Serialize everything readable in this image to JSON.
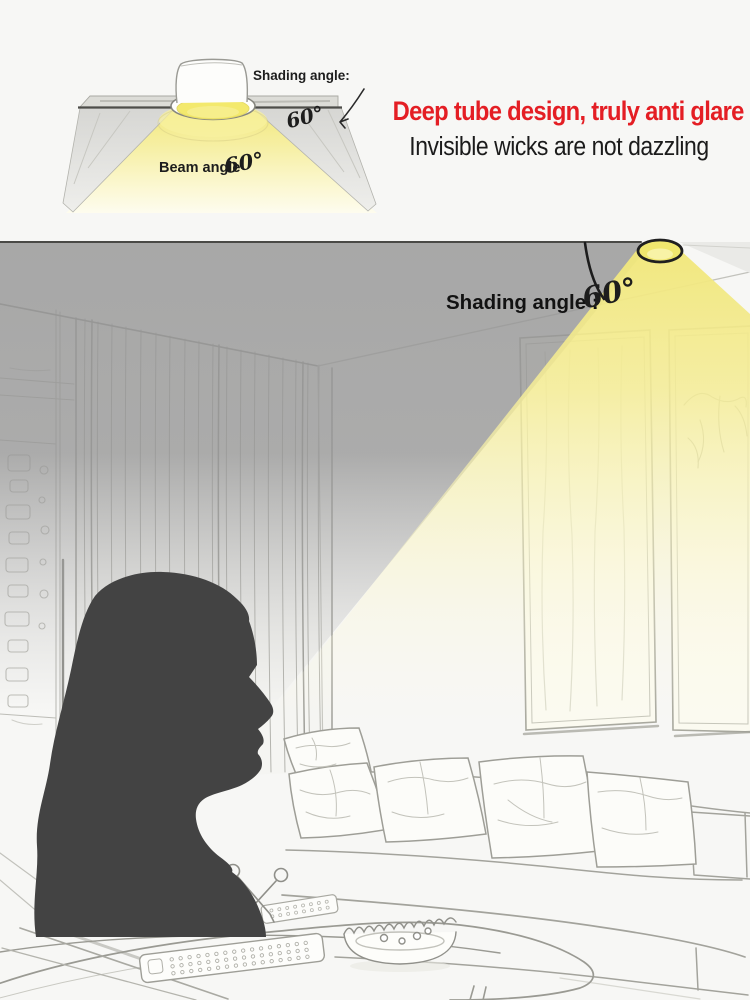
{
  "top_diagram": {
    "icon": "recessed-downlight-cross-section",
    "shading_angle_label": "Shading angle:",
    "shading_angle_value": "60°",
    "beam_angle_label": "Beam angle",
    "beam_angle_value": "60°"
  },
  "headline": {
    "title": "Deep tube design, truly anti glare",
    "title_color": "#e41e24",
    "subtitle": "Invisible wicks are not dazzling",
    "subtitle_color": "#1b1b1b"
  },
  "scene": {
    "shading_angle_label": "Shading angle :",
    "shading_angle_value": "60°",
    "beam_color": "#f2e87c",
    "ceiling_shadow_color": "#cbcbcb",
    "silhouette_color": "#434343",
    "icons": {
      "ceiling_lamp": "ceiling-downlight-icon",
      "angle_arc": "angle-arc-icon",
      "woman": "woman-profile-silhouette",
      "curtain": "sketch-curtain",
      "wall_art": "wall-art-panels",
      "sofa": "sketch-sofa-with-pillows",
      "coffee_table": "sketch-coffee-table",
      "ashtray": "sketch-ashtray-bowl",
      "remote": "sketch-remote-control",
      "scissors": "sketch-scissors"
    }
  }
}
